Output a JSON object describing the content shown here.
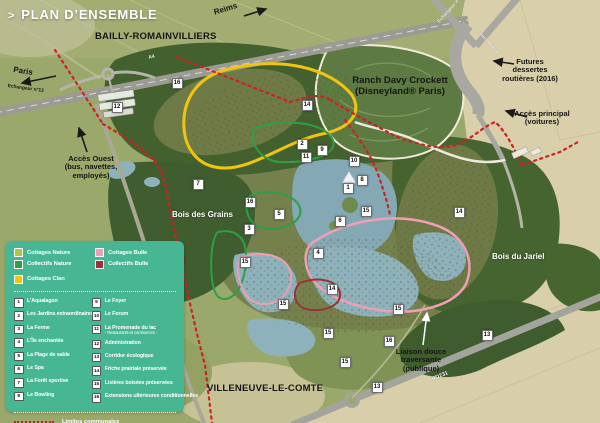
{
  "title": {
    "chevron": ">",
    "text": "PLAN D’ENSEMBLE"
  },
  "map_labels": {
    "bailly": "BAILLY-ROMAINVILLIERS",
    "reims": "Reims",
    "paris": "Paris",
    "echangeur13": "Echangeur n°13",
    "echangeur14": "Echangeur n°14",
    "vers_meaux": "Vers Meaux",
    "a4": "A4",
    "ranch": "Ranch Davy Crockett (Disneyland® Paris)",
    "futures": "Futures dessertes routières (2016)",
    "acces_principal": "Accès principal (voitures)",
    "acces_ouest": "Accès Ouest (bus, navettes, employés)",
    "bois_grains": "Bois des Grains",
    "bois_jariel": "Bois du Jariel",
    "villeneuve": "VILLENEUVE-LE-COMTE",
    "liaison": "Liaison douce traversante (publique)",
    "rd231_south": "RD231",
    "rd231_west": "RD231"
  },
  "legend": {
    "panel_color": "#47b793",
    "zones": [
      {
        "label": "Cottages Nature",
        "color": "#a9c93f"
      },
      {
        "label": "Collectifs Nature",
        "color": "#2f9e44"
      },
      {
        "label": "Cottages Clan",
        "color": "#f1c40f"
      },
      {
        "label": "Cottages Bulle",
        "color": "#ef9fb5"
      },
      {
        "label": "Collectifs Bulle",
        "color": "#9c3138"
      }
    ],
    "items": [
      {
        "num": "1",
        "label": "L’Aqualagon"
      },
      {
        "num": "2",
        "label": "Les Jardins extraordinaires"
      },
      {
        "num": "3",
        "label": "La Ferme"
      },
      {
        "num": "4",
        "label": "L’Île enchantée"
      },
      {
        "num": "5",
        "label": "La Plage de sable"
      },
      {
        "num": "6",
        "label": "Le Spa"
      },
      {
        "num": "7",
        "label": "La Forêt sportive"
      },
      {
        "num": "8",
        "label": "Le Bowling"
      },
      {
        "num": "9",
        "label": "Le Foyer"
      },
      {
        "num": "10",
        "label": "Le Forum"
      },
      {
        "num": "11",
        "label": "La Promenade du lac",
        "sub": "- Restaurants et commerces -"
      },
      {
        "num": "12",
        "label": "Administration"
      },
      {
        "num": "13",
        "label": "Corridor écologique"
      },
      {
        "num": "14",
        "label": "Friche prairiale préservée"
      },
      {
        "num": "15",
        "label": "Lisières boisées préservées"
      },
      {
        "num": "16",
        "label": "Extensions ultérieures conditionnelles"
      }
    ],
    "boundary": {
      "label": "Limites communales",
      "color": "#c1272d"
    }
  },
  "markers": [
    {
      "n": "1",
      "x": 348,
      "y": 188
    },
    {
      "n": "2",
      "x": 302,
      "y": 144
    },
    {
      "n": "3",
      "x": 249,
      "y": 229
    },
    {
      "n": "4",
      "x": 318,
      "y": 253
    },
    {
      "n": "5",
      "x": 279,
      "y": 214
    },
    {
      "n": "6",
      "x": 340,
      "y": 221
    },
    {
      "n": "7",
      "x": 198,
      "y": 184
    },
    {
      "n": "8",
      "x": 362,
      "y": 180
    },
    {
      "n": "9",
      "x": 322,
      "y": 150
    },
    {
      "n": "10",
      "x": 354,
      "y": 161
    },
    {
      "n": "11",
      "x": 306,
      "y": 157
    },
    {
      "n": "12",
      "x": 117,
      "y": 107
    },
    {
      "n": "13",
      "x": 377,
      "y": 387
    },
    {
      "n": "13",
      "x": 487,
      "y": 335
    },
    {
      "n": "14",
      "x": 307,
      "y": 105
    },
    {
      "n": "14",
      "x": 459,
      "y": 212
    },
    {
      "n": "14",
      "x": 332,
      "y": 289
    },
    {
      "n": "15",
      "x": 366,
      "y": 211
    },
    {
      "n": "15",
      "x": 245,
      "y": 262
    },
    {
      "n": "15",
      "x": 283,
      "y": 304
    },
    {
      "n": "15",
      "x": 398,
      "y": 309
    },
    {
      "n": "15",
      "x": 328,
      "y": 333
    },
    {
      "n": "15",
      "x": 345,
      "y": 362
    },
    {
      "n": "16",
      "x": 177,
      "y": 83
    },
    {
      "n": "16",
      "x": 250,
      "y": 202
    },
    {
      "n": "16",
      "x": 389,
      "y": 341
    }
  ]
}
